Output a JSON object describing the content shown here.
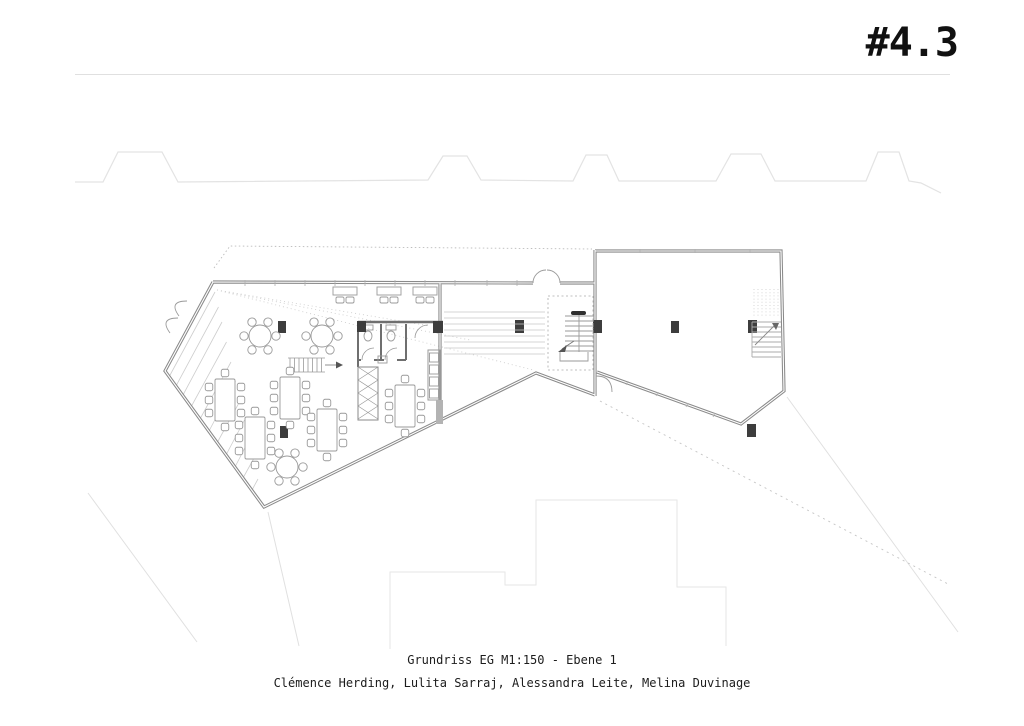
{
  "sheet": {
    "number": "#4.3",
    "caption_title": "Grundriss EG M1:150 - Ebene 1",
    "caption_authors": "Clémence Herding, Lulita Sarraj, Alessandra Leite, Melina Duvinage"
  },
  "drawing": {
    "kind": "architectural floor plan, ground floor (EG), level 1, scale 1:150",
    "features": [
      "dining hall with round and rectangular tables",
      "window counter tables",
      "entrance ramp with hatching",
      "WC block",
      "kitchen counter",
      "dumbwaiter shaft",
      "wide corridor steps",
      "two staircases",
      "second hall wing",
      "site context roofline",
      "neighbouring building outlines",
      "property guide lines"
    ]
  },
  "colors": {
    "background": "#ffffff",
    "text": "#111111",
    "header_rule": "#e0e0e0",
    "wall": "#8a8a8a",
    "interior_line": "#9a9a9a",
    "furniture": "#9a9a9a",
    "column": "#3d3d3d",
    "faint_context": "#e3e3e3",
    "dotted_guide": "#bcbcbc"
  }
}
